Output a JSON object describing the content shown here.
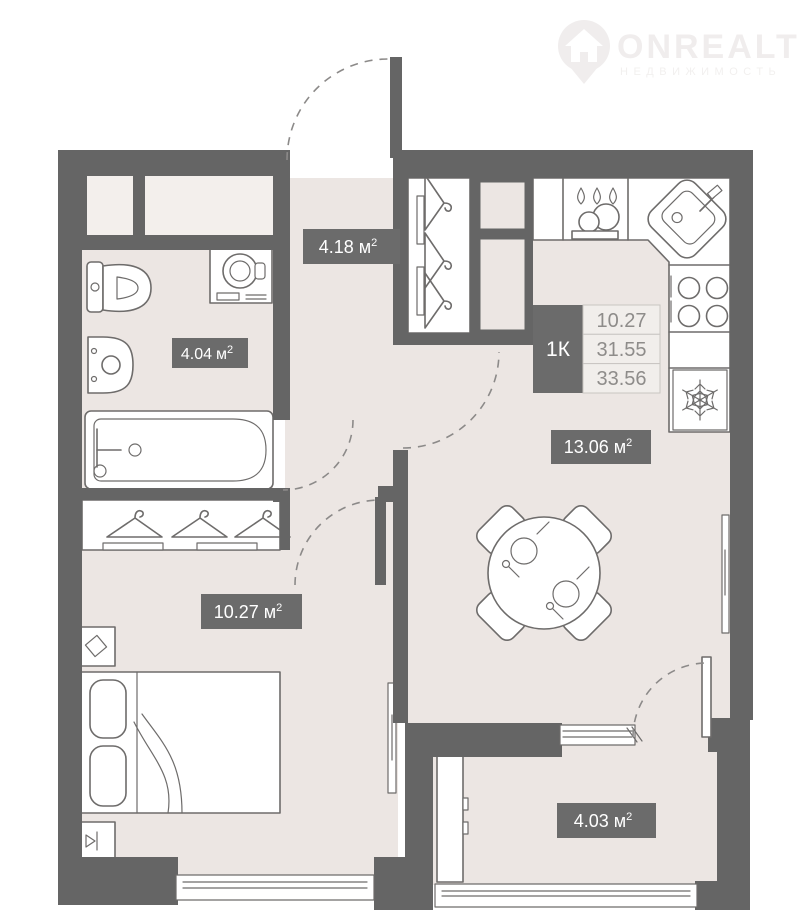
{
  "watermark": {
    "brand": "ONREALT",
    "tagline": "НЕДВИЖИМОСТЬ"
  },
  "info_box": {
    "type": "1К",
    "values": [
      "10.27",
      "31.55",
      "33.56"
    ]
  },
  "unit": {
    "symbol": "м",
    "sup": "2"
  },
  "rooms": [
    {
      "id": "hallway",
      "area": "4.18"
    },
    {
      "id": "bathroom",
      "area": "4.04"
    },
    {
      "id": "kitchen-living",
      "area": "13.06"
    },
    {
      "id": "bedroom",
      "area": "10.27"
    },
    {
      "id": "balcony",
      "area": "4.03"
    }
  ],
  "colors": {
    "wall": "#656565",
    "floor": "#ece6e3",
    "badge": "#6b6b6b",
    "fixture_stroke": "#6e6c6b",
    "table_bg": "#f1eeeb",
    "table_border": "#c9c5c2",
    "table_text": "#8e8c8a",
    "watermark": "#f0eded"
  },
  "fixtures": [
    "toilet",
    "washing-machine",
    "bathroom-sink",
    "bathtub",
    "closet-hangers",
    "wardrobe-hangers",
    "gas-stove",
    "corner-sink",
    "cooktop",
    "refrigerator-snowflake",
    "dining-table",
    "chairs",
    "place-settings",
    "bed",
    "pillows",
    "nightstand",
    "decor-diamond",
    "bedside-lamp",
    "radiator-panel",
    "balcony-cabinet",
    "windows",
    "door-swing-arcs"
  ]
}
